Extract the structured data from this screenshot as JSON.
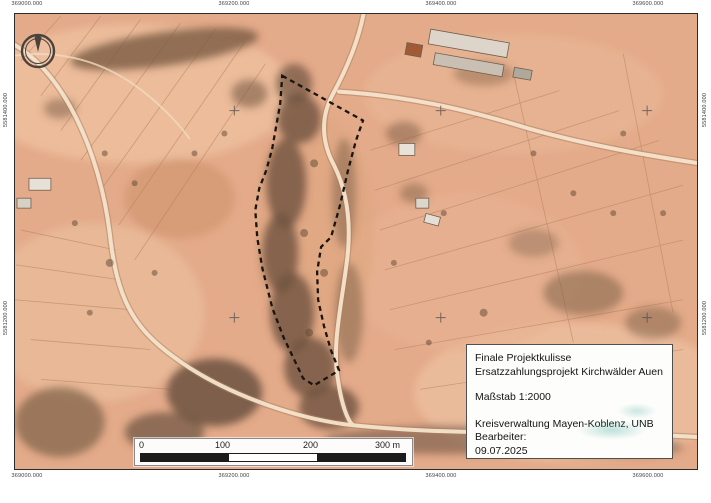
{
  "map": {
    "coordinates": {
      "top": [
        "369000.000",
        "369200.000",
        "369400.000",
        "369600.000"
      ],
      "bottom": [
        "369000.000",
        "369200.000",
        "369400.000",
        "369600.000"
      ],
      "left": [
        "5581400.000",
        "5581200.000"
      ],
      "right": [
        "5581400.000",
        "5581200.000"
      ]
    },
    "icons": {
      "north": "north-arrow-icon"
    },
    "scale_bar": {
      "tick_labels": [
        "0",
        "100",
        "200",
        "300 m"
      ]
    },
    "title_block": {
      "project_line1": "Finale Projektkulisse",
      "project_line2": "Ersatzzahlungsprojekt Kirchwälder Auen",
      "scale_text": "Maßstab 1:2000",
      "authority": "Kreisverwaltung Mayen-Koblenz, UNB",
      "editor_label": "Bearbeiter:",
      "date": "09.07.2025"
    },
    "colors": {
      "photo_base": "#e4ab8a",
      "boundary": "#1a1511",
      "road": "#f6e4cc",
      "woods": "#6f5540",
      "frame": "#2b2b2b"
    }
  }
}
